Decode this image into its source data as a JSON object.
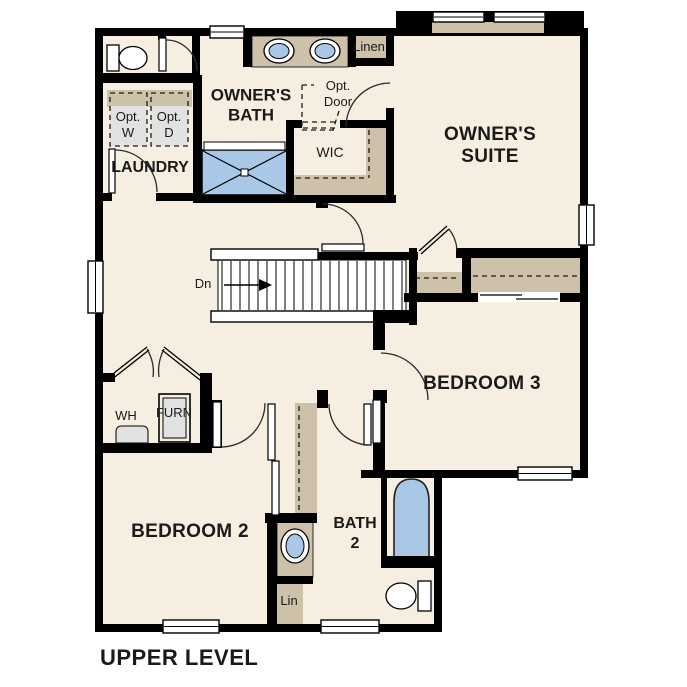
{
  "title": "UPPER LEVEL",
  "colors": {
    "wall": "#000000",
    "floor": "#f6efe1",
    "casework": "#cdc1a9",
    "fixture": "#a9c8e8",
    "appliance": "#e2e2e2",
    "bg": "#ffffff",
    "ink": "#1a1a1a"
  },
  "labels": {
    "owners_bath": "OWNER'S\nBATH",
    "owners_suite": "OWNER'S\nSUITE",
    "bedroom2": "BEDROOM 2",
    "bedroom3": "BEDROOM 3",
    "bath2": "BATH\n2",
    "laundry": "LAUNDRY",
    "wic": "WIC",
    "linen": "Linen",
    "lin": "Lin",
    "opt_w": "Opt.\nW",
    "opt_d": "Opt.\nD",
    "opt_door": "Opt.\nDoor",
    "wh": "WH",
    "furn": "FURN",
    "dn": "Dn"
  },
  "fixtures": [
    "toilet",
    "double-vanity-sinks",
    "shower",
    "bathtub",
    "sink",
    "optional-washer",
    "optional-dryer",
    "water-heater",
    "furnace",
    "stairs-down"
  ]
}
